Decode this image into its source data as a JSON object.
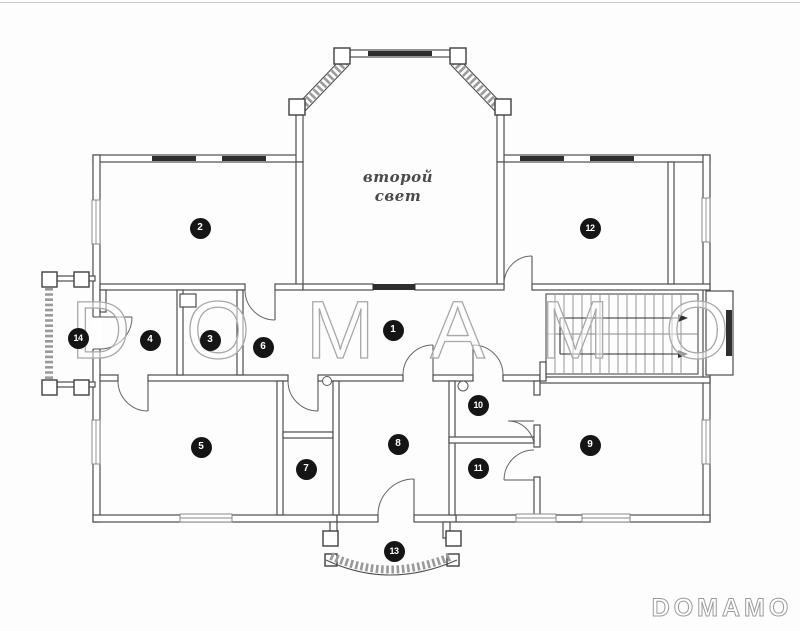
{
  "watermark": {
    "center_text": "DOMAMO",
    "corner_text": "DOMAMO"
  },
  "plan": {
    "central_room_label_line1": "второй",
    "central_room_label_line2": "свет",
    "markers": [
      {
        "label": "1",
        "x": 393,
        "y": 330
      },
      {
        "label": "2",
        "x": 200,
        "y": 228
      },
      {
        "label": "3",
        "x": 210,
        "y": 340
      },
      {
        "label": "4",
        "x": 150,
        "y": 340
      },
      {
        "label": "5",
        "x": 201,
        "y": 447
      },
      {
        "label": "6",
        "x": 263,
        "y": 347
      },
      {
        "label": "7",
        "x": 306,
        "y": 469
      },
      {
        "label": "8",
        "x": 398,
        "y": 444
      },
      {
        "label": "9",
        "x": 590,
        "y": 445
      },
      {
        "label": "10",
        "x": 478,
        "y": 405
      },
      {
        "label": "11",
        "x": 478,
        "y": 468
      },
      {
        "label": "12",
        "x": 590,
        "y": 228
      },
      {
        "label": "13",
        "x": 394,
        "y": 551
      },
      {
        "label": "14",
        "x": 78,
        "y": 338
      }
    ],
    "colors": {
      "wall": "#4d4d4d",
      "window": "#2e2e2e",
      "hatch": "#9a9a9a",
      "watermark": "#a8a8a8",
      "marker_bg": "#151515",
      "marker_text": "#ffffff"
    }
  }
}
